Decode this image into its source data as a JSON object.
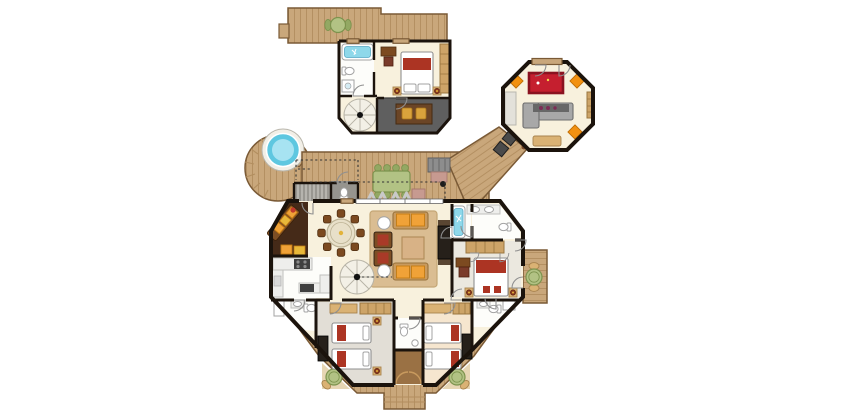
{
  "plan": {
    "type": "resort-villa-floor-plan",
    "elements": [
      "arrival-walkway",
      "roof-deck-dining-table",
      "upper-bedroom",
      "upper-bathroom-tub",
      "upper-spiral-staircase",
      "upper-shaded-terrace",
      "games-pavilion",
      "billiard-table",
      "bar-lounge-sofa",
      "ottoman-poufs",
      "jacuzzi-round-deck",
      "outdoor-dining-table",
      "sun-loungers",
      "daybed",
      "outdoor-wc",
      "outdoor-stairs",
      "living-room",
      "dining-table-round",
      "corner-sofa-nook",
      "kitchen",
      "main-spiral-staircase",
      "master-bathroom",
      "master-bedroom",
      "side-deck-table",
      "twin-bedroom-left",
      "twin-bedroom-right",
      "guest-bathrooms",
      "central-wc",
      "luggage-closet",
      "bottom-deck-tables",
      "jetty-steps"
    ]
  },
  "palette": {
    "wall": "#1b130c",
    "deck": "#c9a77b",
    "deckLine": "#b28e5f",
    "deckEdge": "#7a5a36",
    "deckPale": "#e7d6b4",
    "floorCream": "#f8f1dd",
    "floorWhite": "#fdfdfa",
    "floorGray": "#e2ded6",
    "floorPeach": "#f6e6cf",
    "floorMaster": "#ebe8df",
    "nook": "#452a18",
    "stairFill": "#999791",
    "stairLine": "#d2d0ca",
    "outWc": "#96948e",
    "terrace": "#5f5f5f",
    "terraceEdge": "#3d3d3d",
    "terraceTable": "#6b4526",
    "rug": "#dabd92",
    "rugEdge": "#c4a675",
    "poolBlue": "#5ec7e0",
    "poolLight": "#a7e3f2",
    "poolRim": "#f2efe7",
    "tubBlue": "#8ed8ea",
    "tubEdge": "#57a8c5",
    "bedRed": "#ac3423",
    "bedOutline": "#8f8f8f",
    "orange": "#f0a238",
    "orangeEdge": "#c47c12",
    "pouf": "#f29111",
    "poufEdge": "#c06e05",
    "sofaTan": "#c89a5e",
    "sofaEdge": "#97713a",
    "armBrown": "#7d4e24",
    "armRed": "#a93a28",
    "coffee": "#d8b286",
    "coffeeEdge": "#b08b58",
    "chairWood": "#7c4a20",
    "tableCream": "#e8e0c9",
    "tableEdge": "#bcb294",
    "tvDark": "#26201a",
    "counter": "#eeeeec",
    "counterEdge": "#c0c0bd",
    "hob": "#3f3f3f",
    "greenTop": "#b2c284",
    "greenEdge": "#7d934e",
    "greenChair": "#93a863",
    "daybed": "#8d8d8d",
    "daybedEdge": "#5e5e5e",
    "mauve": "#c79a90",
    "mauveEdge": "#a3756b",
    "graySofa": "#a8a8a8",
    "graySofaEdge": "#6e6e6e",
    "barTop": "#676767",
    "bottle": "#7c2c55",
    "billiard": "#c51f2f",
    "billiardEdge": "#8a1220",
    "benchTan": "#dab274",
    "benchEdge": "#a8834e",
    "wardrobe": "#cda468",
    "wardrobeEdge": "#9a763f",
    "chairDark": "#4a4a4a",
    "lamp": "#8a3a1e",
    "lampGold": "#e2b33a",
    "fixture": "#ffffff",
    "fixtureEdge": "#a3a3a3",
    "spiral": "#f3f0e6",
    "spiralLine": "#b7b3a6",
    "arc": "#8f8f8f",
    "dash": "#333333",
    "closet": "#9a7144",
    "closetArc": "#c89a5e",
    "lounger": "#c9c9c9"
  }
}
